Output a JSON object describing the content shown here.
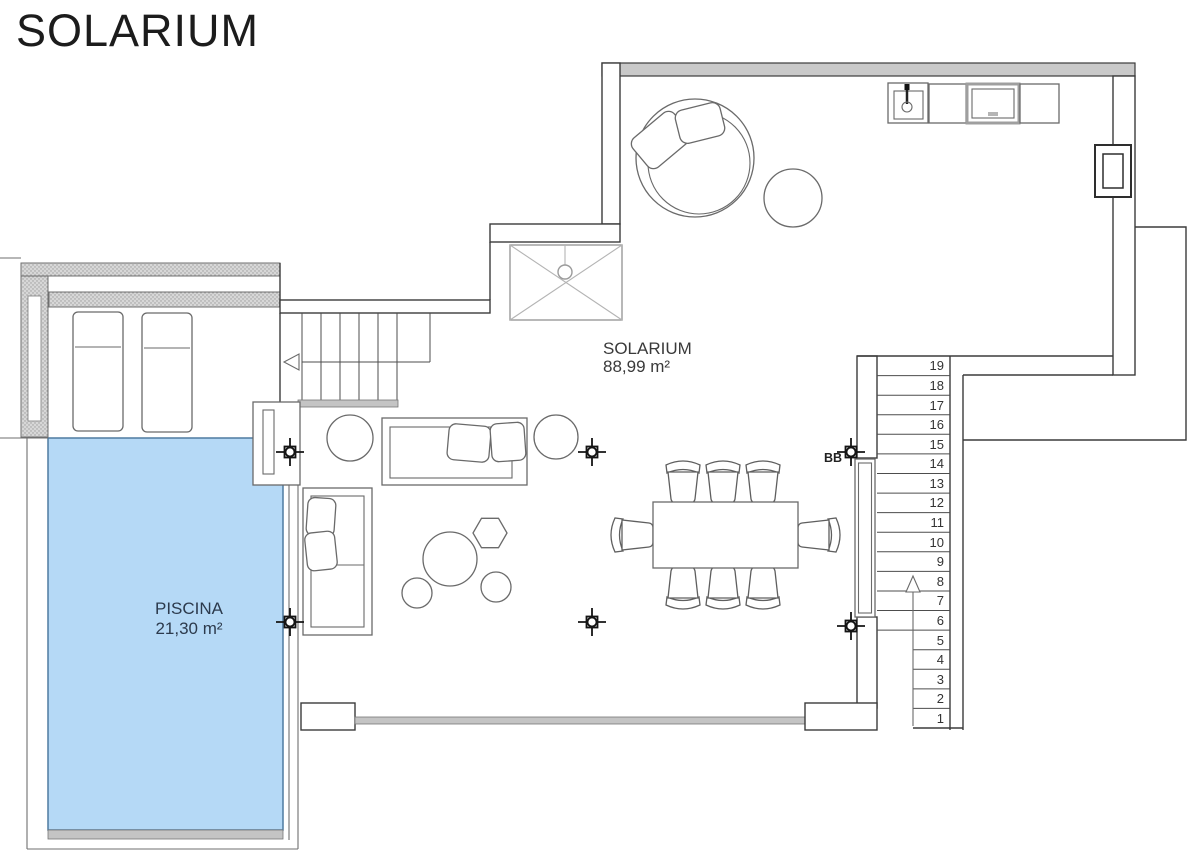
{
  "title": "SOLARIUM",
  "rooms": {
    "solarium": {
      "name": "SOLARIUM",
      "area": "88,99 m²"
    },
    "piscina": {
      "name": "PISCINA",
      "area": "21,30 m²"
    }
  },
  "labels": {
    "bbq": "BB"
  },
  "stairs": {
    "steps": [
      "19",
      "18",
      "17",
      "16",
      "15",
      "14",
      "13",
      "12",
      "11",
      "10",
      "9",
      "8",
      "7",
      "6",
      "5",
      "4",
      "3",
      "2",
      "1"
    ]
  },
  "colors": {
    "pool_fill": "#b5d9f6",
    "pool_stroke": "#4f7ba0",
    "pool_text": "#2c3a4c",
    "line": "#3b3b3b",
    "furn": "#6a6a6a",
    "wall_band": "#c9c9c9",
    "gray_band": "#c4c4c4",
    "text": "#3a3a3a"
  }
}
